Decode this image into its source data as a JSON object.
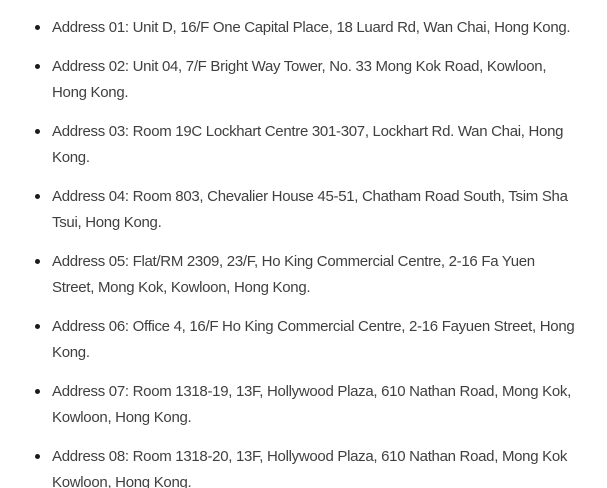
{
  "page": {
    "background_color": "#ffffff",
    "text_color": "#404040",
    "bullet_color": "#1b1b1b"
  },
  "address_list": {
    "items": [
      "Address 01: Unit D, 16/F One Capital Place, 18 Luard Rd, Wan Chai, Hong Kong.",
      "Address 02: Unit 04, 7/F Bright Way Tower, No. 33 Mong Kok Road, Kowloon, Hong Kong.",
      "Address 03: Room 19C Lockhart Centre 301-307, Lockhart Rd. Wan Chai, Hong Kong.",
      "Address 04: Room 803, Chevalier House 45-51, Chatham Road South, Tsim Sha Tsui, Hong Kong.",
      "Address 05: Flat/RM 2309, 23/F, Ho King Commercial Centre, 2-16 Fa Yuen Street, Mong Kok, Kowloon, Hong Kong.",
      "Address 06: Office 4, 16/F Ho King Commercial Centre, 2-16 Fayuen Street, Hong Kong.",
      "Address 07: Room 1318-19, 13F, Hollywood Plaza, 610 Nathan Road, Mong Kok, Kowloon, Hong Kong.",
      "Address 08: Room 1318-20, 13F, Hollywood Plaza, 610 Nathan Road, Mong Kok Kowloon, Hong Kong."
    ]
  }
}
